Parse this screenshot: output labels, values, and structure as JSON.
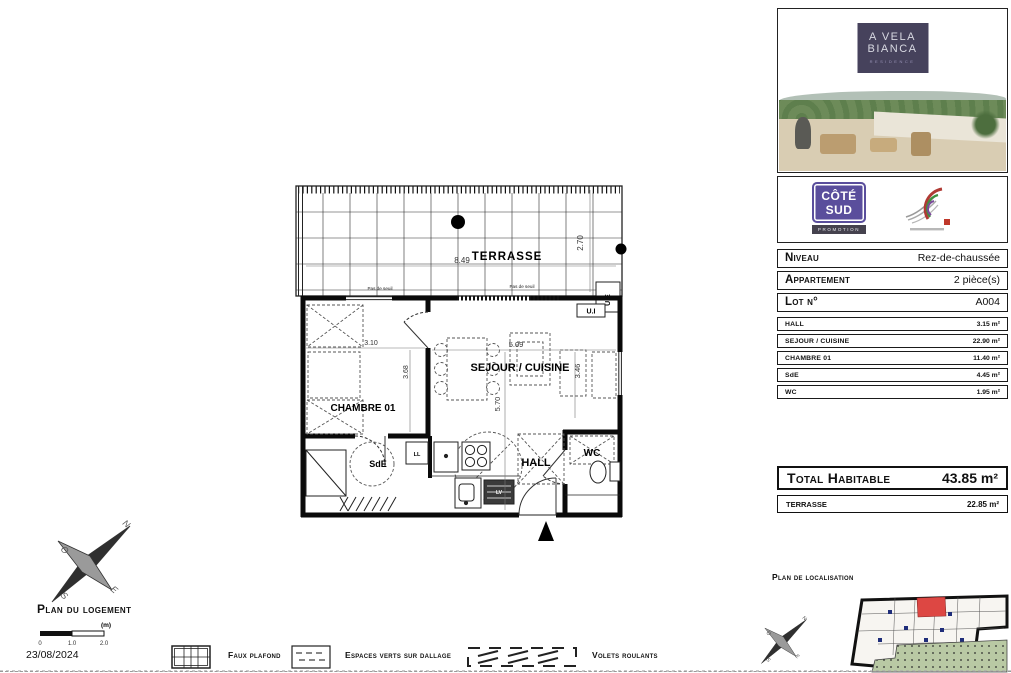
{
  "page": {
    "title": "Plan du logement",
    "date": "23/08/2024"
  },
  "branding": {
    "residence": {
      "line1": "A VELA",
      "line2": "BIANCA",
      "subtitle": "RESIDENCE"
    },
    "promoter": {
      "line1": "CÔTÉ",
      "line2": "SUD",
      "subtitle": "PROMOTION"
    }
  },
  "info_rows": [
    {
      "label": "Niveau",
      "value": "Rez-de-chaussée"
    },
    {
      "label": "Appartement",
      "value": "2 pièce(s)"
    },
    {
      "label": "Lot n°",
      "value": "A004"
    }
  ],
  "rooms": [
    {
      "name": "HALL",
      "area": "3.15 m²"
    },
    {
      "name": "SEJOUR / CUISINE",
      "area": "22.90 m²"
    },
    {
      "name": "CHAMBRE 01",
      "area": "11.40 m²"
    },
    {
      "name": "SdE",
      "area": "4.45 m²"
    },
    {
      "name": "WC",
      "area": "1.95 m²"
    }
  ],
  "totals": {
    "habitable_label": "Total Habitable",
    "habitable_value": "43.85 m²",
    "terrasse_label": "TERRASSE",
    "terrasse_value": "22.85 m²"
  },
  "localisation": {
    "title": "Plan de localisation"
  },
  "legend": [
    {
      "label": "Faux plafond"
    },
    {
      "label": "Espaces verts sur dallage"
    },
    {
      "label": "Volets roulants"
    }
  ],
  "plan": {
    "labels": {
      "terrasse": "TERRASSE",
      "sejour": "SEJOUR / CUISINE",
      "chambre": "CHAMBRE 01",
      "sde": "SdE",
      "hall": "HALL",
      "wc": "WC"
    },
    "dimensions": {
      "terrasse_width": "8.49",
      "terrasse_depth": "2.70",
      "sejour_width": "5.09",
      "sejour_depth": "5.70",
      "sejour_width2": "3.46",
      "chambre_width": "3.10",
      "chambre_depth": "3.68"
    },
    "annotations": {
      "exterior_unit": "U.E",
      "interior_unit": "U.I",
      "threshold_left": "Pas de seuil",
      "threshold_right": "Pas de seuil",
      "washing_machine": "LL",
      "dishwasher": "LV"
    }
  },
  "compass": {
    "north": "N",
    "south": "S",
    "east": "E",
    "west": "O"
  },
  "scale_bar": {
    "unit": "(m)",
    "ticks": [
      "0",
      "1.0",
      "2.0"
    ]
  }
}
